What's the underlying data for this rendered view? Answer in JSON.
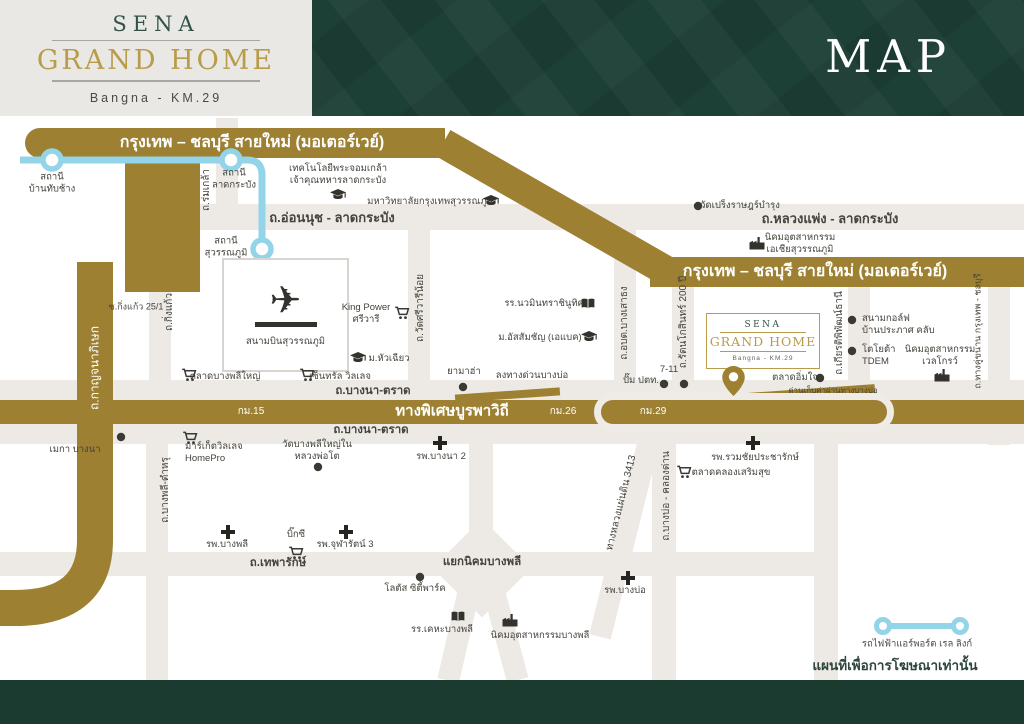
{
  "header": {
    "logo": {
      "brand": "SENA",
      "name": "GRAND HOME",
      "location": "Bangna - KM.29"
    },
    "title": "MAP"
  },
  "colors": {
    "gold_road": "#9d8032",
    "logo_gold": "#b99c49",
    "header_green": "#1d4036",
    "bottom_bar_green": "#1b3a30",
    "rail_blue": "#93d4e8",
    "road_gray": "#edeae6",
    "text_dark": "#44433c",
    "brand_teal": "#33524a"
  },
  "airport": {
    "label": "สนามบินสุวรรณภูมิ"
  },
  "project_box": {
    "brand": "SENA",
    "name": "GRAND HOME",
    "location": "Bangna - KM.29"
  },
  "legend": {
    "rail_label": "รถไฟฟ้าแอร์พอร์ต เรล ลิงก์"
  },
  "disclaimer": "แผนที่เพื่อการโฆษณาเท่านั้น",
  "labels": [
    {
      "name": "motorway-label-top",
      "text": "กรุงเทพ – ชลบุรี สายใหม่ (มอเตอร์เวย์)",
      "x": 252,
      "y": 143,
      "cls": "hwy"
    },
    {
      "name": "motorway-label-right",
      "text": "กรุงเทพ – ชลบุรี สายใหม่ (มอเตอร์เวย์)",
      "x": 815,
      "y": 272,
      "cls": "hwy"
    },
    {
      "name": "expressway-label",
      "text": "ทางพิเศษบูรพาวิถี",
      "x": 452,
      "y": 412,
      "cls": "hwy2"
    },
    {
      "name": "km-15",
      "text": "กม.15",
      "x": 251,
      "y": 412,
      "cls": "km"
    },
    {
      "name": "km-26",
      "text": "กม.26",
      "x": 563,
      "y": 412,
      "cls": "km"
    },
    {
      "name": "km-29",
      "text": "กม.29",
      "x": 653,
      "y": 412,
      "cls": "km"
    },
    {
      "name": "road-onnut",
      "text": "ถ.อ่อนนุช - ลาดกระบัง",
      "x": 332,
      "y": 218,
      "cls": "road"
    },
    {
      "name": "road-luangphaeng",
      "text": "ถ.หลวงแพ่ง - ลาดกระบัง",
      "x": 830,
      "y": 219,
      "cls": "road"
    },
    {
      "name": "road-bangna-trad-top",
      "text": "ถ.บางนา-ตราด",
      "x": 373,
      "y": 391,
      "cls": "road2"
    },
    {
      "name": "road-bangna-trad-bottom",
      "text": "ถ.บางนา-ตราด",
      "x": 371,
      "y": 430,
      "cls": "road2"
    },
    {
      "name": "road-thepharak",
      "text": "ถ.เทพารักษ์",
      "x": 278,
      "y": 563,
      "cls": "road2"
    },
    {
      "name": "junction-nikhom-bangphli",
      "text": "แยกนิคมบางพลี",
      "x": 482,
      "y": 562,
      "cls": "road2"
    },
    {
      "name": "road-romklao",
      "text": "ถ.ร่มเกล้า",
      "x": 207,
      "y": 190,
      "cls": "vroad"
    },
    {
      "name": "road-kingkaeo",
      "text": "ถ.กิ่งแก้ว",
      "x": 170,
      "y": 312,
      "cls": "vroad"
    },
    {
      "name": "soi-kingkaeo",
      "text": "ซ.กิ่งแก้ว 25/1",
      "x": 136,
      "y": 307,
      "cls": "vroadsm",
      "rot": 0
    },
    {
      "name": "road-wat-si-wari-noi",
      "text": "ถ.วัดศรีวารีน้อย",
      "x": 421,
      "y": 308,
      "cls": "vroad"
    },
    {
      "name": "road-obt-bang-sao-thong",
      "text": "ถ.อบต.บางเสาธง",
      "x": 625,
      "y": 323,
      "cls": "vroad"
    },
    {
      "name": "road-rattanakosin-200",
      "text": "ถ.รัตนโกสินทร์ 200 ปี",
      "x": 684,
      "y": 322,
      "cls": "vroad"
    },
    {
      "name": "road-kiat-phiphat",
      "text": "ถ.เกียรติพิพัฒน์ธานี",
      "x": 840,
      "y": 333,
      "cls": "vroad"
    },
    {
      "name": "road-parallel-bkk-chonburi",
      "text": "ถ.ทางคู่ขนาน กรุงเทพ - ชลบุรี",
      "x": 978,
      "y": 331,
      "cls": "vroadsm"
    },
    {
      "name": "road-kanchanaphisek",
      "text": "ถ.กาญจนาภิเษก",
      "x": 95,
      "y": 368,
      "cls": "vroadw"
    },
    {
      "name": "road-bangphli-tamru",
      "text": "ถ.บางพลี-ตำหรุ",
      "x": 166,
      "y": 490,
      "cls": "vroad"
    },
    {
      "name": "road-highway-3413",
      "text": "ทางหลวงแผ่นดิน 3413",
      "x": 622,
      "y": 503,
      "cls": "vroad",
      "rot": -76
    },
    {
      "name": "road-bangbo-khlongdan",
      "text": "ถ.บางบ่อ - คลองด่าน",
      "x": 667,
      "y": 496,
      "cls": "vroad"
    },
    {
      "name": "exit-bangbo",
      "text": "ลงทางด่วนบางบ่อ",
      "x": 532,
      "y": 376,
      "cls": "poi"
    },
    {
      "name": "station-ban-thap-chang",
      "text": "สถานี\nบ้านทับช้าง",
      "x": 52,
      "y": 184,
      "cls": "stn"
    },
    {
      "name": "station-lat-krabang",
      "text": "สถานี\nลาดกระบัง",
      "x": 234,
      "y": 180,
      "cls": "stn"
    },
    {
      "name": "station-suvarnabhumi",
      "text": "สถานี\nสุวรรณภูมิ",
      "x": 226,
      "y": 248,
      "cls": "stn"
    },
    {
      "name": "poi-kmitl",
      "text": "เทคโนโลยีพระจอมเกล้า\nเจ้าคุณทหารลาดกระบัง",
      "x": 338,
      "y": 175,
      "cls": "poi",
      "icon": "school",
      "ix": 338,
      "iy": 195
    },
    {
      "name": "poi-bangkok-suvarnabhumi-univ",
      "text": "มหาวิทยาลัยกรุงเทพสุวรรณภูมิ",
      "x": 430,
      "y": 202,
      "cls": "poi",
      "icon": "school",
      "ix": 491,
      "iy": 201
    },
    {
      "name": "poi-wat-preng",
      "text": "วัดเปร็งราษฎร์บำรุง",
      "x": 740,
      "y": 206,
      "cls": "poi",
      "icon": "dot",
      "ix": 698,
      "iy": 206
    },
    {
      "name": "poi-asia-industrial-estate",
      "text": "นิคมอุตสาหกรรม\nเอเชียสุวรรณภูมิ",
      "x": 800,
      "y": 244,
      "cls": "poi",
      "icon": "factory",
      "ix": 757,
      "iy": 243
    },
    {
      "name": "poi-king-power-sriwaree",
      "text": "King Power\nศรีวารี",
      "x": 366,
      "y": 314,
      "cls": "poi",
      "icon": "cart",
      "ix": 402,
      "iy": 313
    },
    {
      "name": "poi-huachiew-univ",
      "text": "ม.หัวเฉียว",
      "x": 389,
      "y": 359,
      "cls": "poi",
      "icon": "school",
      "ix": 358,
      "iy": 358
    },
    {
      "name": "poi-central-village",
      "text": "เซ็นทรัล วิลเลจ",
      "x": 340,
      "y": 377,
      "cls": "poi",
      "icon": "cart",
      "ix": 307,
      "iy": 375
    },
    {
      "name": "poi-talad-bangphli-yai",
      "text": "ตลาดบางพลีใหญ่",
      "x": 225,
      "y": 377,
      "cls": "poi",
      "icon": "cart",
      "ix": 189,
      "iy": 375
    },
    {
      "name": "poi-nawamin-school",
      "text": "รร.นวมินทราชินูทิศ",
      "x": 544,
      "y": 304,
      "cls": "poi",
      "icon": "book",
      "ix": 588,
      "iy": 304
    },
    {
      "name": "poi-abac",
      "text": "ม.อัสสัมชัญ (เอแบค)",
      "x": 540,
      "y": 338,
      "cls": "poi",
      "icon": "school",
      "ix": 589,
      "iy": 337
    },
    {
      "name": "poi-yamaha",
      "text": "ยามาฮ่า",
      "x": 464,
      "y": 372,
      "cls": "poi",
      "icon": "dot",
      "ix": 463,
      "iy": 387
    },
    {
      "name": "poi-7-11",
      "text": "7-11",
      "x": 669,
      "y": 370,
      "cls": "poi",
      "icon": "dot",
      "ix": 684,
      "iy": 384
    },
    {
      "name": "poi-ptt",
      "text": "ปั๊ม ปตท.",
      "x": 641,
      "y": 381,
      "cls": "poi",
      "icon": "dot",
      "ix": 664,
      "iy": 384
    },
    {
      "name": "poi-talad-imjai",
      "text": "ตลาดอิ่มใจ",
      "x": 795,
      "y": 378,
      "cls": "poi",
      "icon": "dot",
      "ix": 820,
      "iy": 378
    },
    {
      "name": "toll-bangbo",
      "text": "ด่านเก็บค่าผ่านทางบางบ่อ",
      "x": 833,
      "y": 391,
      "cls": "poism"
    },
    {
      "name": "poi-golf-club",
      "text": "สนามกอล์ฟ\nบ้านประภาศ คลับ",
      "x": 862,
      "y": 325,
      "cls": "poi",
      "align": "l",
      "icon": "dot",
      "ix": 852,
      "iy": 320
    },
    {
      "name": "poi-toyota-tdem",
      "text": "โตโยต้า\nTDEM",
      "x": 862,
      "y": 356,
      "cls": "poi",
      "align": "l",
      "icon": "dot",
      "ix": 852,
      "iy": 351
    },
    {
      "name": "poi-wellgrow-industrial",
      "text": "นิคมอุตสาหกรรม\nเวลโกรว์",
      "x": 940,
      "y": 356,
      "cls": "poi",
      "icon": "factory",
      "ix": 942,
      "iy": 375
    },
    {
      "name": "poi-market-village-homepro",
      "text": "มาร์เก็ตวิลเลจ\nHomePro",
      "x": 185,
      "y": 453,
      "cls": "poi",
      "align": "l",
      "icon": "cart",
      "ix": 190,
      "iy": 438
    },
    {
      "name": "poi-wat-bangphli-yai-nai",
      "text": "วัดบางพลีใหญ่ใน\nหลวงพ่อโต",
      "x": 317,
      "y": 451,
      "cls": "poi",
      "icon": "dot",
      "ix": 318,
      "iy": 467
    },
    {
      "name": "poi-bangna2-hospital",
      "text": "รพ.บางนา 2",
      "x": 441,
      "y": 457,
      "cls": "poi",
      "icon": "cross",
      "ix": 440,
      "iy": 443
    },
    {
      "name": "poi-bangphli-hospital",
      "text": "รพ.บางพลี",
      "x": 227,
      "y": 545,
      "cls": "poi",
      "icon": "cross",
      "ix": 228,
      "iy": 532
    },
    {
      "name": "poi-bigc",
      "text": "บิ๊กซี",
      "x": 296,
      "y": 535,
      "cls": "poi",
      "icon": "cart",
      "ix": 296,
      "iy": 553
    },
    {
      "name": "poi-chularat3-hospital",
      "text": "รพ.จุฬารัตน์ 3",
      "x": 345,
      "y": 545,
      "cls": "poi",
      "icon": "cross",
      "ix": 346,
      "iy": 532
    },
    {
      "name": "poi-lotus-city-park",
      "text": "โลตัส ซิตี้พาร์ค",
      "x": 415,
      "y": 589,
      "cls": "poi",
      "icon": "dot",
      "ix": 420,
      "iy": 577
    },
    {
      "name": "poi-kheha-bangphli-school",
      "text": "รร.เคหะบางพลี",
      "x": 442,
      "y": 630,
      "cls": "poi",
      "icon": "book",
      "ix": 458,
      "iy": 617
    },
    {
      "name": "poi-nikhom-bangphli-industrial",
      "text": "นิคมอุตสาหกรรมบางพลี",
      "x": 540,
      "y": 636,
      "cls": "poi",
      "icon": "factory",
      "ix": 510,
      "iy": 620
    },
    {
      "name": "poi-bangbo-hospital",
      "text": "รพ.บางบ่อ",
      "x": 625,
      "y": 591,
      "cls": "poi",
      "icon": "cross",
      "ix": 628,
      "iy": 578
    },
    {
      "name": "poi-ruamchai-pracharak-hospital",
      "text": "รพ.รวมชัยประชารักษ์",
      "x": 755,
      "y": 458,
      "cls": "poi",
      "icon": "cross",
      "ix": 753,
      "iy": 443
    },
    {
      "name": "poi-talad-soemsuk",
      "text": "ตลาดคลองเสริมสุข",
      "x": 731,
      "y": 473,
      "cls": "poi",
      "icon": "cart",
      "ix": 684,
      "iy": 472
    },
    {
      "name": "poi-mega-bangna",
      "text": "เมกา บางนา",
      "x": 75,
      "y": 450,
      "cls": "poi",
      "icon": "dot",
      "ix": 121,
      "iy": 437
    }
  ]
}
